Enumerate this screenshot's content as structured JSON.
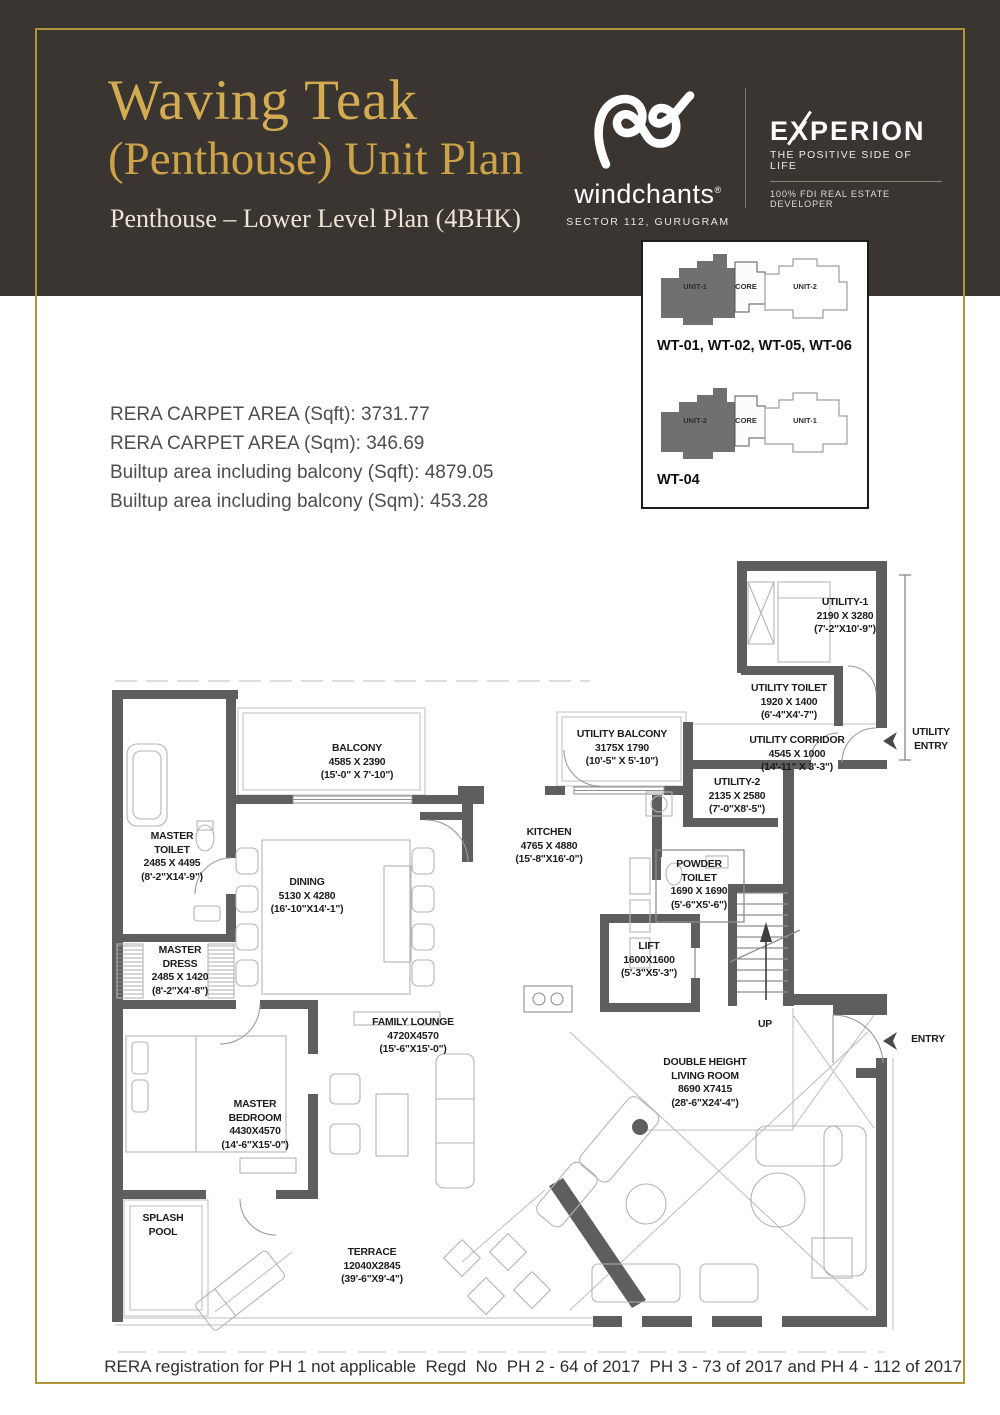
{
  "header": {
    "title_line1": "Waving Teak",
    "title_line2": "(Penthouse) Unit Plan",
    "subtitle": "Penthouse – Lower Level Plan (4BHK)",
    "windchants": {
      "name": "windchants",
      "reg": "®",
      "location": "SECTOR 112, GURUGRAM"
    },
    "experion": {
      "name": "EXPERION",
      "tagline": "THE POSITIVE SIDE OF LIFE",
      "subtext": "100% FDI REAL ESTATE DEVELOPER"
    }
  },
  "areas": {
    "rera_sqft": "RERA CARPET AREA (Sqft): 3731.77",
    "rera_sqm": "RERA CARPET AREA (Sqm): 346.69",
    "builtup_sqft": "Builtup area including balcony (Sqft): 4879.05",
    "builtup_sqm": "Builtup area including balcony (Sqm): 453.28"
  },
  "keyplan": {
    "plan1": {
      "left_unit": "UNIT-1",
      "core": "CORE",
      "right_unit": "UNIT-2",
      "caption": "WT-01, WT-02, WT-05, WT-06"
    },
    "plan2": {
      "left_unit": "UNIT-2",
      "core": "CORE",
      "right_unit": "UNIT-1",
      "caption": "WT-04"
    }
  },
  "plan": {
    "rooms": [
      {
        "name": "BALCONY",
        "mm": "4585 X 2390",
        "ft": "(15'-0\" X 7'-10\")"
      },
      {
        "name": "UTILITY BALCONY",
        "mm": "3175X 1790",
        "ft": "(10'-5\" X 5'-10\")"
      },
      {
        "name": "UTILITY-1",
        "mm": "2190 X 3280",
        "ft": "(7'-2\"X10'-9\")"
      },
      {
        "name": "UTILITY TOILET",
        "mm": "1920 X 1400",
        "ft": "(6'-4\"X4'-7\")"
      },
      {
        "name": "UTILITY CORRIDOR",
        "mm": "4545 X 1000",
        "ft": "(14'-11\" X 3'-3\")"
      },
      {
        "name": "UTILITY-2",
        "mm": "2135 X 2580",
        "ft": "(7'-0\"X8'-5\")"
      },
      {
        "name": "KITCHEN",
        "mm": "4765 X 4880",
        "ft": "(15'-8\"X16'-0\")"
      },
      {
        "name": "MASTER TOILET",
        "mm": "2485 X 4495",
        "ft": "(8'-2\"X14'-9\")"
      },
      {
        "name": "DINING",
        "mm": "5130 X 4280",
        "ft": "(16'-10\"X14'-1\")"
      },
      {
        "name": "MASTER DRESS",
        "mm": "2485 X 1420",
        "ft": "(8'-2\"X4'-8\")"
      },
      {
        "name": "POWDER TOILET",
        "mm": "1690 X 1690",
        "ft": "(5'-6\"X5'-6\")"
      },
      {
        "name": "LIFT",
        "mm": "1600X1600",
        "ft": "(5'-3\"X5'-3\")"
      },
      {
        "name": "FAMILY LOUNGE",
        "mm": "4720X4570",
        "ft": "(15'-6\"X15'-0\")"
      },
      {
        "name": "MASTER BEDROOM",
        "mm": "4430X4570",
        "ft": "(14'-6\"X15'-0\")"
      },
      {
        "name": "DOUBLE HEIGHT LIVING ROOM",
        "mm": "8690 X7415",
        "ft": "(28'-6\"X24'-4\")"
      },
      {
        "name": "SPLASH POOL"
      },
      {
        "name": "TERRACE",
        "mm": "12040X2845",
        "ft": "(39'-6\"X9'-4\")"
      }
    ],
    "labels": {
      "up": "UP",
      "entry": "ENTRY",
      "utility_entry": "UTILITY ENTRY"
    }
  },
  "footer": {
    "text": "RERA registration for PH 1 not applicable  Regd  No  PH 2 - 64 of 2017  PH 3 - 73 of 2017 and PH 4 - 112 of 2017"
  }
}
